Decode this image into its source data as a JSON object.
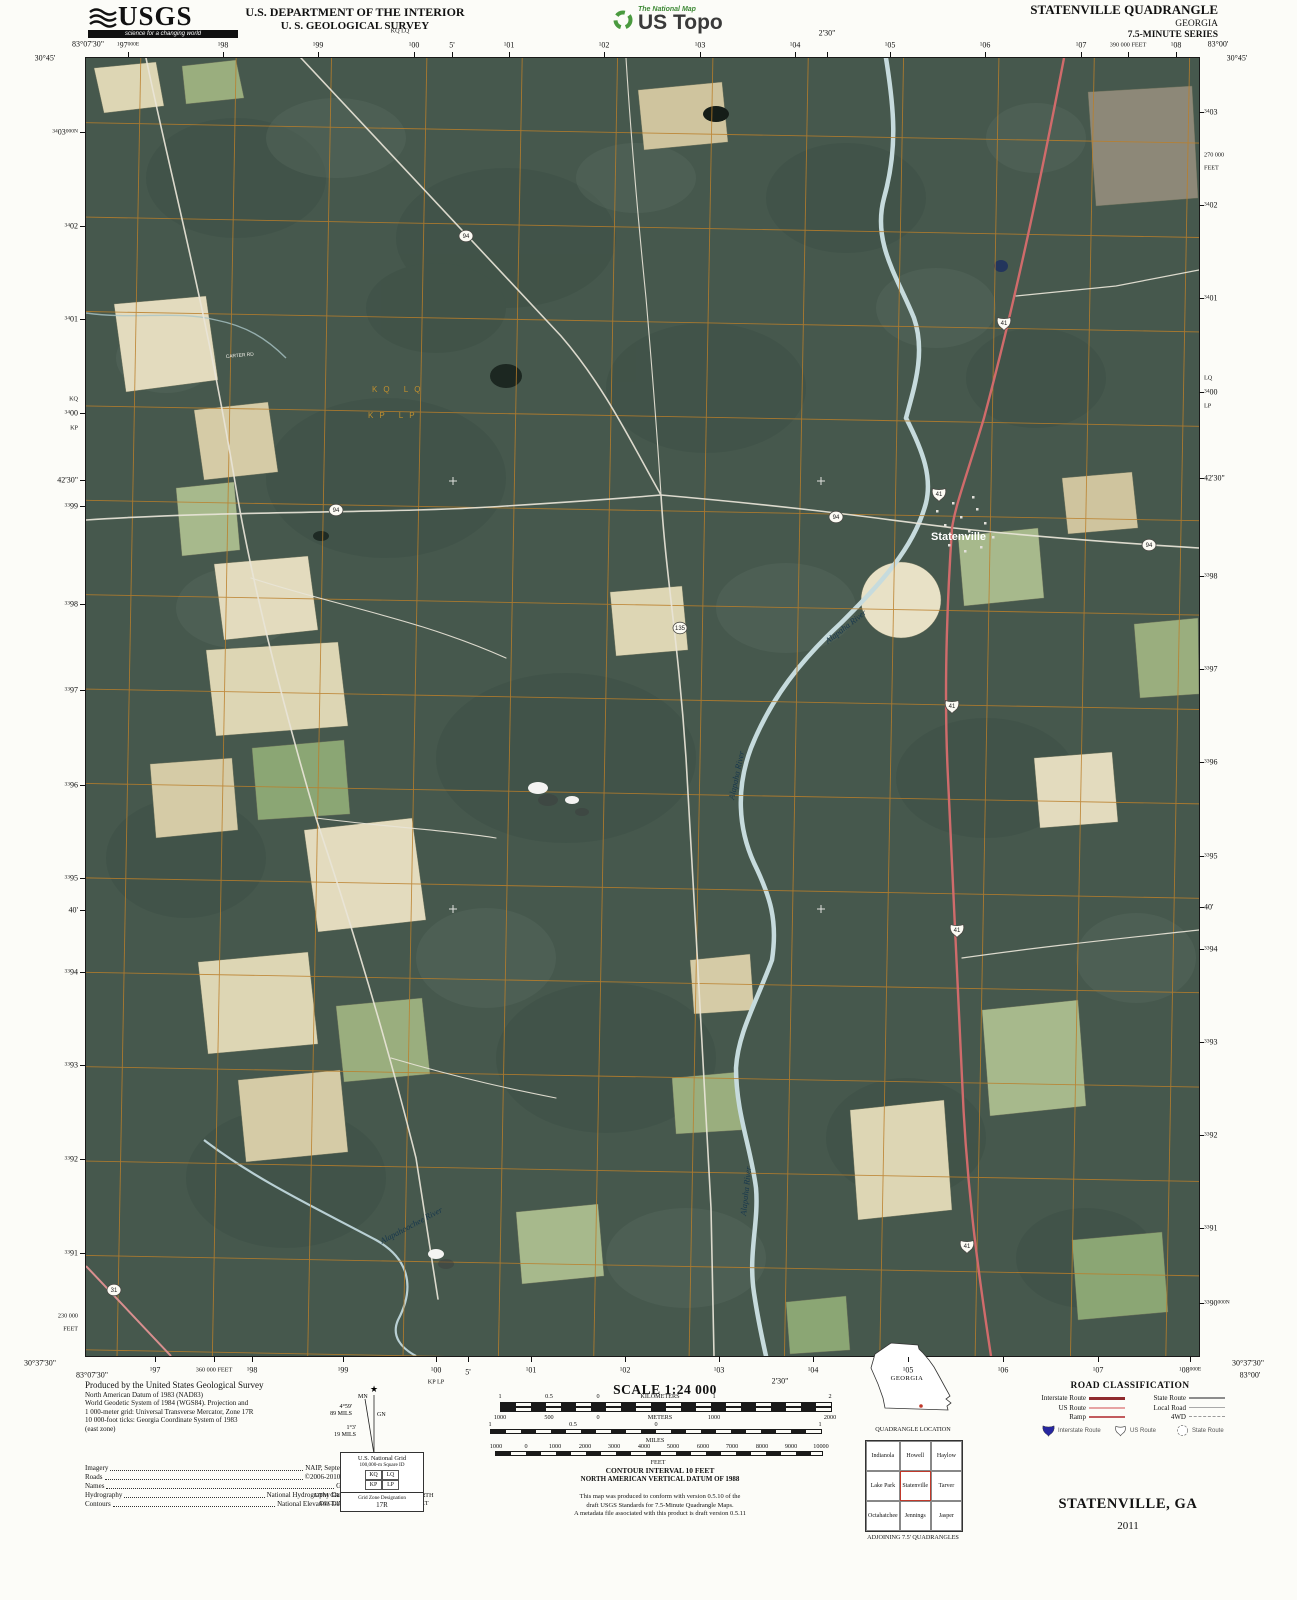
{
  "header": {
    "usgs": {
      "name": "USGS",
      "tagline": "science for a changing world"
    },
    "dept_line1": "U.S. DEPARTMENT OF THE INTERIOR",
    "dept_line2": "U. S. GEOLOGICAL SURVEY",
    "ustopo": {
      "small": "The National Map",
      "large": "US Topo"
    },
    "quad_line1": "STATENVILLE QUADRANGLE",
    "quad_line2": "GEORGIA",
    "quad_line3": "7.5-MINUTE SERIES"
  },
  "map": {
    "colors": {
      "grid": "#bb7f2a",
      "water": "#c6dbdd",
      "us_route": "#d06b6b",
      "forest": "#46584d"
    },
    "labels": {
      "town": "Statenville",
      "river1": "Alapaha River",
      "river2": "Alapaha River",
      "river3": "Alapaha River",
      "river4": "Alapahoochee River",
      "road1": "CARTER RD",
      "usng_row1": "KQ  LQ",
      "usng_row2": "KP  LP"
    },
    "shields": [
      {
        "k": "us",
        "n": "41",
        "x": 918,
        "y": 265
      },
      {
        "k": "us",
        "n": "41",
        "x": 853,
        "y": 436
      },
      {
        "k": "us",
        "n": "41",
        "x": 866,
        "y": 648
      },
      {
        "k": "us",
        "n": "41",
        "x": 871,
        "y": 872
      },
      {
        "k": "us",
        "n": "41",
        "x": 881,
        "y": 1188
      },
      {
        "k": "c",
        "n": "94",
        "x": 380,
        "y": 178
      },
      {
        "k": "c",
        "n": "94",
        "x": 250,
        "y": 452
      },
      {
        "k": "c",
        "n": "94",
        "x": 750,
        "y": 459
      },
      {
        "k": "c",
        "n": "94",
        "x": 1063,
        "y": 487
      },
      {
        "k": "c",
        "n": "135",
        "x": 594,
        "y": 570
      },
      {
        "k": "c",
        "n": "31",
        "x": 28,
        "y": 1232
      }
    ],
    "margins": {
      "top": [
        {
          "x": 88,
          "y": 44,
          "m": "83°07'30\"",
          "nt": 1,
          "c": 1
        },
        {
          "x": 45,
          "y": 58,
          "m": "30°45'",
          "nt": 1,
          "c": 1
        },
        {
          "x": 128,
          "y": 45,
          "s": "1",
          "m": "97",
          "e": "000E"
        },
        {
          "x": 223,
          "y": 45,
          "s": "1",
          "m": "98"
        },
        {
          "x": 318,
          "y": 45,
          "s": "1",
          "m": "99"
        },
        {
          "x": 400,
          "y": 31,
          "m": "KQ LQ",
          "nt": 1,
          "f": 1
        },
        {
          "x": 414,
          "y": 45,
          "s": "1",
          "m": "00"
        },
        {
          "x": 452,
          "y": 45,
          "m": "5'"
        },
        {
          "x": 509,
          "y": 45,
          "s": "1",
          "m": "01"
        },
        {
          "x": 604,
          "y": 45,
          "s": "1",
          "m": "02"
        },
        {
          "x": 700,
          "y": 45,
          "s": "1",
          "m": "03"
        },
        {
          "x": 795,
          "y": 45,
          "s": "1",
          "m": "04"
        },
        {
          "x": 827,
          "y": 33,
          "m": "2'30\""
        },
        {
          "x": 890,
          "y": 45,
          "s": "1",
          "m": "05"
        },
        {
          "x": 985,
          "y": 45,
          "s": "1",
          "m": "06"
        },
        {
          "x": 1081,
          "y": 45,
          "s": "1",
          "m": "07"
        },
        {
          "x": 1128,
          "y": 45,
          "m": "390 000 FEET",
          "f": 1
        },
        {
          "x": 1176,
          "y": 45,
          "s": "1",
          "m": "08"
        },
        {
          "x": 1218,
          "y": 44,
          "m": "83°00'",
          "nt": 1,
          "c": 1
        },
        {
          "x": 1237,
          "y": 58,
          "m": "30°45'",
          "nt": 1,
          "c": 1
        }
      ],
      "bottom": [
        {
          "x": 40,
          "y": 1363,
          "m": "30°37'30\"",
          "nt": 1,
          "c": 1
        },
        {
          "x": 92,
          "y": 1375,
          "m": "83°07'30\"",
          "nt": 1,
          "c": 1
        },
        {
          "x": 155,
          "y": 1370,
          "s": "1",
          "m": "97"
        },
        {
          "x": 214,
          "y": 1370,
          "m": "360 000 FEET",
          "f": 1
        },
        {
          "x": 252,
          "y": 1370,
          "s": "1",
          "m": "98"
        },
        {
          "x": 343,
          "y": 1370,
          "s": "1",
          "m": "99"
        },
        {
          "x": 436,
          "y": 1370,
          "s": "1",
          "m": "00"
        },
        {
          "x": 436,
          "y": 1382,
          "m": "KP LP",
          "nt": 1,
          "f": 1
        },
        {
          "x": 468,
          "y": 1372,
          "m": "5'"
        },
        {
          "x": 531,
          "y": 1370,
          "s": "1",
          "m": "01"
        },
        {
          "x": 625,
          "y": 1370,
          "s": "1",
          "m": "02"
        },
        {
          "x": 719,
          "y": 1370,
          "s": "1",
          "m": "03"
        },
        {
          "x": 780,
          "y": 1381,
          "m": "2'30\"",
          "nt": 1
        },
        {
          "x": 813,
          "y": 1370,
          "s": "1",
          "m": "04"
        },
        {
          "x": 908,
          "y": 1370,
          "s": "1",
          "m": "05"
        },
        {
          "x": 1003,
          "y": 1370,
          "s": "1",
          "m": "06"
        },
        {
          "x": 1098,
          "y": 1370,
          "s": "1",
          "m": "07"
        },
        {
          "x": 1190,
          "y": 1370,
          "s": "1",
          "m": "08",
          "e": "000E"
        },
        {
          "x": 1248,
          "y": 1363,
          "m": "30°37'30\"",
          "nt": 1,
          "c": 1
        },
        {
          "x": 1250,
          "y": 1375,
          "m": "83°00'",
          "nt": 1,
          "c": 1
        }
      ],
      "left": [
        {
          "y": 132,
          "s": "34",
          "m": "03",
          "e": "000N"
        },
        {
          "y": 226,
          "s": "34",
          "m": "02"
        },
        {
          "y": 319,
          "s": "34",
          "m": "01"
        },
        {
          "y": 399,
          "m": "KQ",
          "nt": 1,
          "f": 1
        },
        {
          "y": 413,
          "s": "34",
          "m": "00"
        },
        {
          "y": 428,
          "m": "KP",
          "nt": 1,
          "f": 1
        },
        {
          "y": 480,
          "m": "42'30\""
        },
        {
          "y": 506,
          "s": "33",
          "m": "99"
        },
        {
          "y": 604,
          "s": "33",
          "m": "98"
        },
        {
          "y": 690,
          "s": "33",
          "m": "97"
        },
        {
          "y": 785,
          "s": "33",
          "m": "96"
        },
        {
          "y": 878,
          "s": "33",
          "m": "95"
        },
        {
          "y": 910,
          "m": "40'"
        },
        {
          "y": 972,
          "s": "33",
          "m": "94"
        },
        {
          "y": 1065,
          "s": "33",
          "m": "93"
        },
        {
          "y": 1159,
          "s": "33",
          "m": "92"
        },
        {
          "y": 1253,
          "s": "33",
          "m": "91"
        },
        {
          "y": 1316,
          "m": "230 000",
          "nt": 1,
          "f": 1
        },
        {
          "y": 1329,
          "m": "FEET",
          "nt": 1,
          "f": 1
        }
      ],
      "right": [
        {
          "y": 112,
          "s": "34",
          "m": "03"
        },
        {
          "y": 155,
          "m": "270 000",
          "nt": 1,
          "f": 1
        },
        {
          "y": 168,
          "m": "FEET",
          "nt": 1,
          "f": 1
        },
        {
          "y": 205,
          "s": "34",
          "m": "02"
        },
        {
          "y": 298,
          "s": "34",
          "m": "01"
        },
        {
          "y": 378,
          "m": "LQ",
          "nt": 1,
          "f": 1
        },
        {
          "y": 392,
          "s": "34",
          "m": "00"
        },
        {
          "y": 406,
          "m": "LP",
          "nt": 1,
          "f": 1
        },
        {
          "y": 478,
          "m": "42'30\""
        },
        {
          "y": 576,
          "s": "33",
          "m": "98"
        },
        {
          "y": 669,
          "s": "33",
          "m": "97"
        },
        {
          "y": 762,
          "s": "33",
          "m": "96"
        },
        {
          "y": 856,
          "s": "33",
          "m": "95"
        },
        {
          "y": 907,
          "m": "40'"
        },
        {
          "y": 949,
          "s": "33",
          "m": "94"
        },
        {
          "y": 1042,
          "s": "33",
          "m": "93"
        },
        {
          "y": 1135,
          "s": "33",
          "m": "92"
        },
        {
          "y": 1228,
          "s": "33",
          "m": "91"
        },
        {
          "y": 1303,
          "s": "33",
          "m": "90",
          "e": "000N"
        }
      ]
    }
  },
  "footer": {
    "produced_lines": [
      "Produced by the United States Geological Survey",
      "North American Datum of 1983 (NAD83)",
      "World Geodetic System of 1984 (WGS84).  Projection and",
      "1 000-meter grid: Universal Transverse Mercator, Zone 17R",
      "10 000-foot ticks: Georgia Coordinate System of 1983",
      "(east zone)"
    ],
    "credits": [
      {
        "k": "Imagery",
        "v": "NAIP, September 2009"
      },
      {
        "k": "Roads",
        "v": "©2006-2010 Tele Atlas"
      },
      {
        "k": "Names",
        "v": "GNIS, 2009"
      },
      {
        "k": "Hydrography",
        "v": "National Hydrography Dataset, 2009"
      },
      {
        "k": "Contours",
        "v": "National Elevation Dataset, 2008"
      }
    ],
    "declination": {
      "star": "★",
      "mn": "MN",
      "gn": "GN",
      "mn_deg": "4°59'",
      "mn_mils": "89 MILS",
      "gn_deg": "1°3'",
      "gn_mils": "19 MILS",
      "cap1": "UTM GRID AND 2011 MAGNETIC NORTH",
      "cap2": "DECLINATION AT CENTER OF SHEET"
    },
    "usng": {
      "title": "U.S. National Grid",
      "sub": "100,000-m Square ID",
      "squares": [
        "KQ",
        "LQ",
        "KP",
        "LP"
      ],
      "zone_caption": "Grid Zone Designation",
      "zone": "17R"
    },
    "scale": {
      "title": "SCALE 1:24 000",
      "bars": [
        {
          "unit": "KILOMETERS",
          "ly": 1393,
          "ux": 660,
          "uy": 1393,
          "labels": [
            [
              "1",
              500
            ],
            [
              "0.5",
              549
            ],
            [
              "0",
              598
            ],
            [
              "1",
              714
            ],
            [
              "2",
              830
            ]
          ]
        },
        {
          "unit": "METERS",
          "ly": 1414,
          "ux": 660,
          "uy": 1414,
          "labels": [
            [
              "1000",
              500
            ],
            [
              "500",
              549
            ],
            [
              "0",
              598
            ],
            [
              "1000",
              714
            ],
            [
              "2000",
              830
            ]
          ]
        },
        {
          "unit": "MILES",
          "ly": 1421,
          "ux": 655,
          "uy": 1437,
          "labels": [
            [
              "1",
              490
            ],
            [
              "0.5",
              573
            ],
            [
              "0",
              656
            ],
            [
              "1",
              820
            ]
          ]
        },
        {
          "unit": "FEET",
          "ly": 1443,
          "ux": 658,
          "uy": 1459,
          "labels": [
            [
              "1000",
              496
            ],
            [
              "0",
              526
            ],
            [
              "1000",
              555
            ],
            [
              "2000",
              585
            ],
            [
              "3000",
              614
            ],
            [
              "4000",
              644
            ],
            [
              "5000",
              673
            ],
            [
              "6000",
              703
            ],
            [
              "7000",
              732
            ],
            [
              "8000",
              762
            ],
            [
              "9000",
              791
            ],
            [
              "10000",
              821
            ]
          ]
        }
      ]
    },
    "contour1": "CONTOUR INTERVAL 10 FEET",
    "contour2": "NORTH AMERICAN VERTICAL DATUM OF 1988",
    "conform": [
      "This map was produced to conform with version 0.5.10 of the",
      "draft USGS Standards for 7.5-Minute Quadrangle Maps.",
      "A metadata file associated with this product is draft version 0.5.11"
    ],
    "location": {
      "state": "GEORGIA",
      "caption": "QUADRANGLE LOCATION"
    },
    "adjoining": {
      "cells": [
        "Indianola",
        "Howell",
        "Haylow",
        "Lake Park",
        "Statenville",
        "Tarver",
        "Octahatchee",
        "Jennings",
        "Jasper"
      ],
      "caption": "ADJOINING 7.5' QUADRANGLES"
    },
    "road_class": {
      "title": "ROAD CLASSIFICATION",
      "rows_left": [
        {
          "l": "Interstate Route",
          "k": "interstate"
        },
        {
          "l": "US Route",
          "k": "us"
        },
        {
          "l": "Ramp",
          "k": "ramp"
        }
      ],
      "rows_right": [
        {
          "l": "State Route",
          "k": "state"
        },
        {
          "l": "Local Road",
          "k": "local"
        },
        {
          "l": "4WD",
          "k": "fwd"
        }
      ],
      "shields": [
        {
          "k": "interstate",
          "l": "Interstate Route"
        },
        {
          "k": "us",
          "l": "US Route"
        },
        {
          "k": "state",
          "l": "State Route"
        }
      ]
    },
    "sheet_name": "STATENVILLE, GA",
    "year": "2011"
  }
}
